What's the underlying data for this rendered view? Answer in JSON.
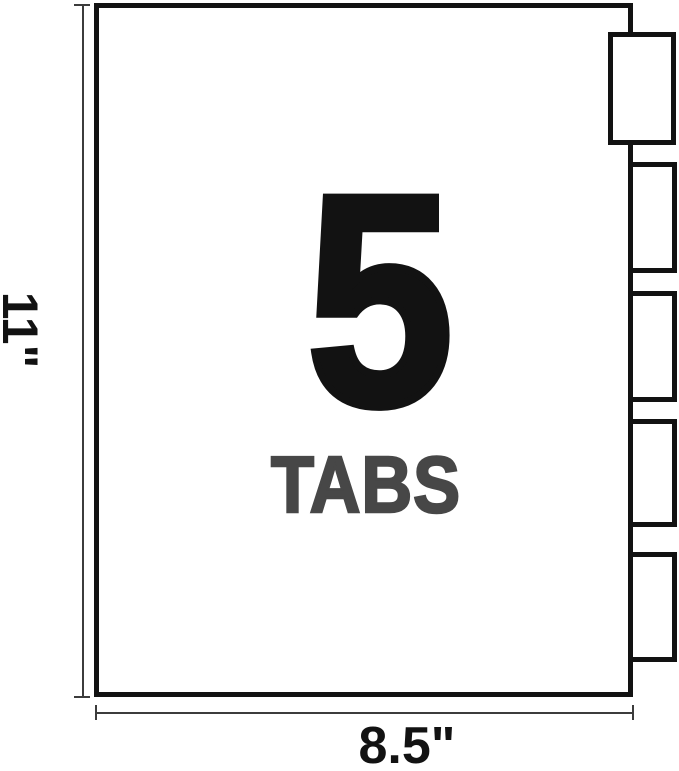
{
  "figure": {
    "count": "5",
    "label": "TABS",
    "height_label": "11\"",
    "width_label": "8.5\"",
    "tab_count": 5
  },
  "colors": {
    "outline": "#121212",
    "count_text": "#121212",
    "label_text": "#474747",
    "dimension_line": "#3c3c3c",
    "background": "#ffffff"
  }
}
